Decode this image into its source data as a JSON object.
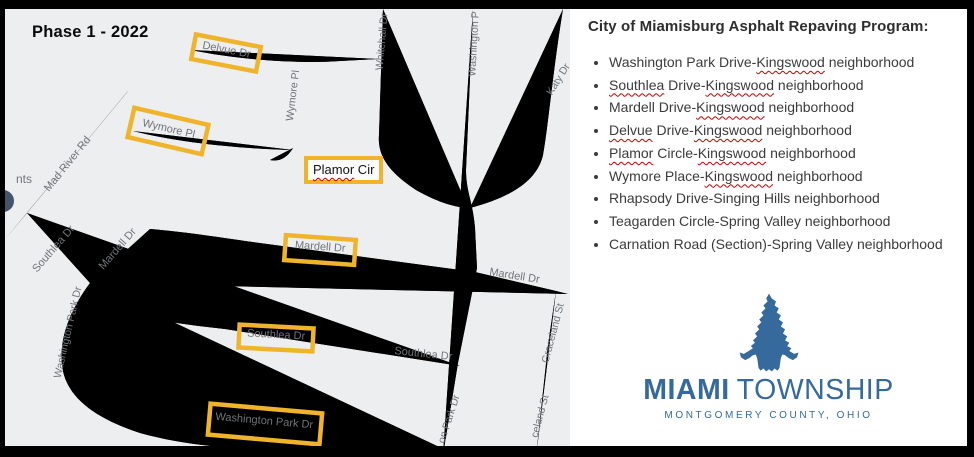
{
  "map": {
    "phase_label": "Phase 1 - 2022",
    "background_color": "#eceef0",
    "highlight_color": "#f0b42c",
    "road_color": "#ffffff",
    "street_label_color": "#71757a",
    "partial_poi_label": "nts",
    "poi_icon_color": "#44536b",
    "plamor_annotation": {
      "misspelled_word": "Plamor",
      "suffix": " Cir"
    },
    "street_labels": [
      {
        "text": "Mad River Rd"
      },
      {
        "text": "Delvue Dr"
      },
      {
        "text": "Wymore Pl"
      },
      {
        "text": "Wymore Pl"
      },
      {
        "text": "Whitehall Dr"
      },
      {
        "text": "Washington P"
      },
      {
        "text": "Katy Dr"
      },
      {
        "text": "Mardell Dr"
      },
      {
        "text": "Mardell Dr"
      },
      {
        "text": "Mardell Dr"
      },
      {
        "text": "Southlea Dr"
      },
      {
        "text": "Southlea Dr"
      },
      {
        "text": "Southlea Dr"
      },
      {
        "text": "Washington Park Dr"
      },
      {
        "text": "Washington Park Dr"
      },
      {
        "text": "on Park Dr"
      },
      {
        "text": "Graceland St"
      },
      {
        "text": "celand St"
      }
    ]
  },
  "panel": {
    "title": "City of Miamisburg Asphalt Repaving Program:",
    "spellcheck_color": "#c40000",
    "items": [
      {
        "segments": [
          {
            "text": "Washington Park Drive-",
            "misspelled": false
          },
          {
            "text": "Kingswood",
            "misspelled": true
          },
          {
            "text": " neighborhood",
            "misspelled": false
          }
        ]
      },
      {
        "segments": [
          {
            "text": "Southlea",
            "misspelled": true
          },
          {
            "text": " Drive-",
            "misspelled": false
          },
          {
            "text": "Kingswood",
            "misspelled": true
          },
          {
            "text": " neighborhood",
            "misspelled": false
          }
        ]
      },
      {
        "segments": [
          {
            "text": "Mardell Drive-",
            "misspelled": false
          },
          {
            "text": "Kingswood",
            "misspelled": true
          },
          {
            "text": " neighborhood",
            "misspelled": false
          }
        ]
      },
      {
        "segments": [
          {
            "text": "Delvue",
            "misspelled": true
          },
          {
            "text": " Drive-",
            "misspelled": false
          },
          {
            "text": "Kingswood",
            "misspelled": true
          },
          {
            "text": " neighborhood",
            "misspelled": false
          }
        ]
      },
      {
        "segments": [
          {
            "text": "Plamor",
            "misspelled": true
          },
          {
            "text": " Circle-",
            "misspelled": false
          },
          {
            "text": "Kingswood",
            "misspelled": true
          },
          {
            "text": " neighborhood",
            "misspelled": false
          }
        ]
      },
      {
        "segments": [
          {
            "text": "Wymore Place-",
            "misspelled": false
          },
          {
            "text": "Kingswood",
            "misspelled": true
          },
          {
            "text": " neighborhood",
            "misspelled": false
          }
        ]
      },
      {
        "segments": [
          {
            "text": "Rhapsody Drive-Singing Hills neighborhood",
            "misspelled": false
          }
        ]
      },
      {
        "segments": [
          {
            "text": "Teagarden Circle-Spring Valley neighborhood",
            "misspelled": false
          }
        ]
      },
      {
        "segments": [
          {
            "text": "Carnation Road (Section)-Spring Valley neighborhood",
            "misspelled": false
          }
        ]
      }
    ]
  },
  "logo": {
    "name_primary": "MIAMI",
    "name_secondary": "TOWNSHIP",
    "subtitle": "MONTGOMERY COUNTY, OHIO",
    "brand_color": "#36699c",
    "mark": "arrowhead-icon"
  }
}
